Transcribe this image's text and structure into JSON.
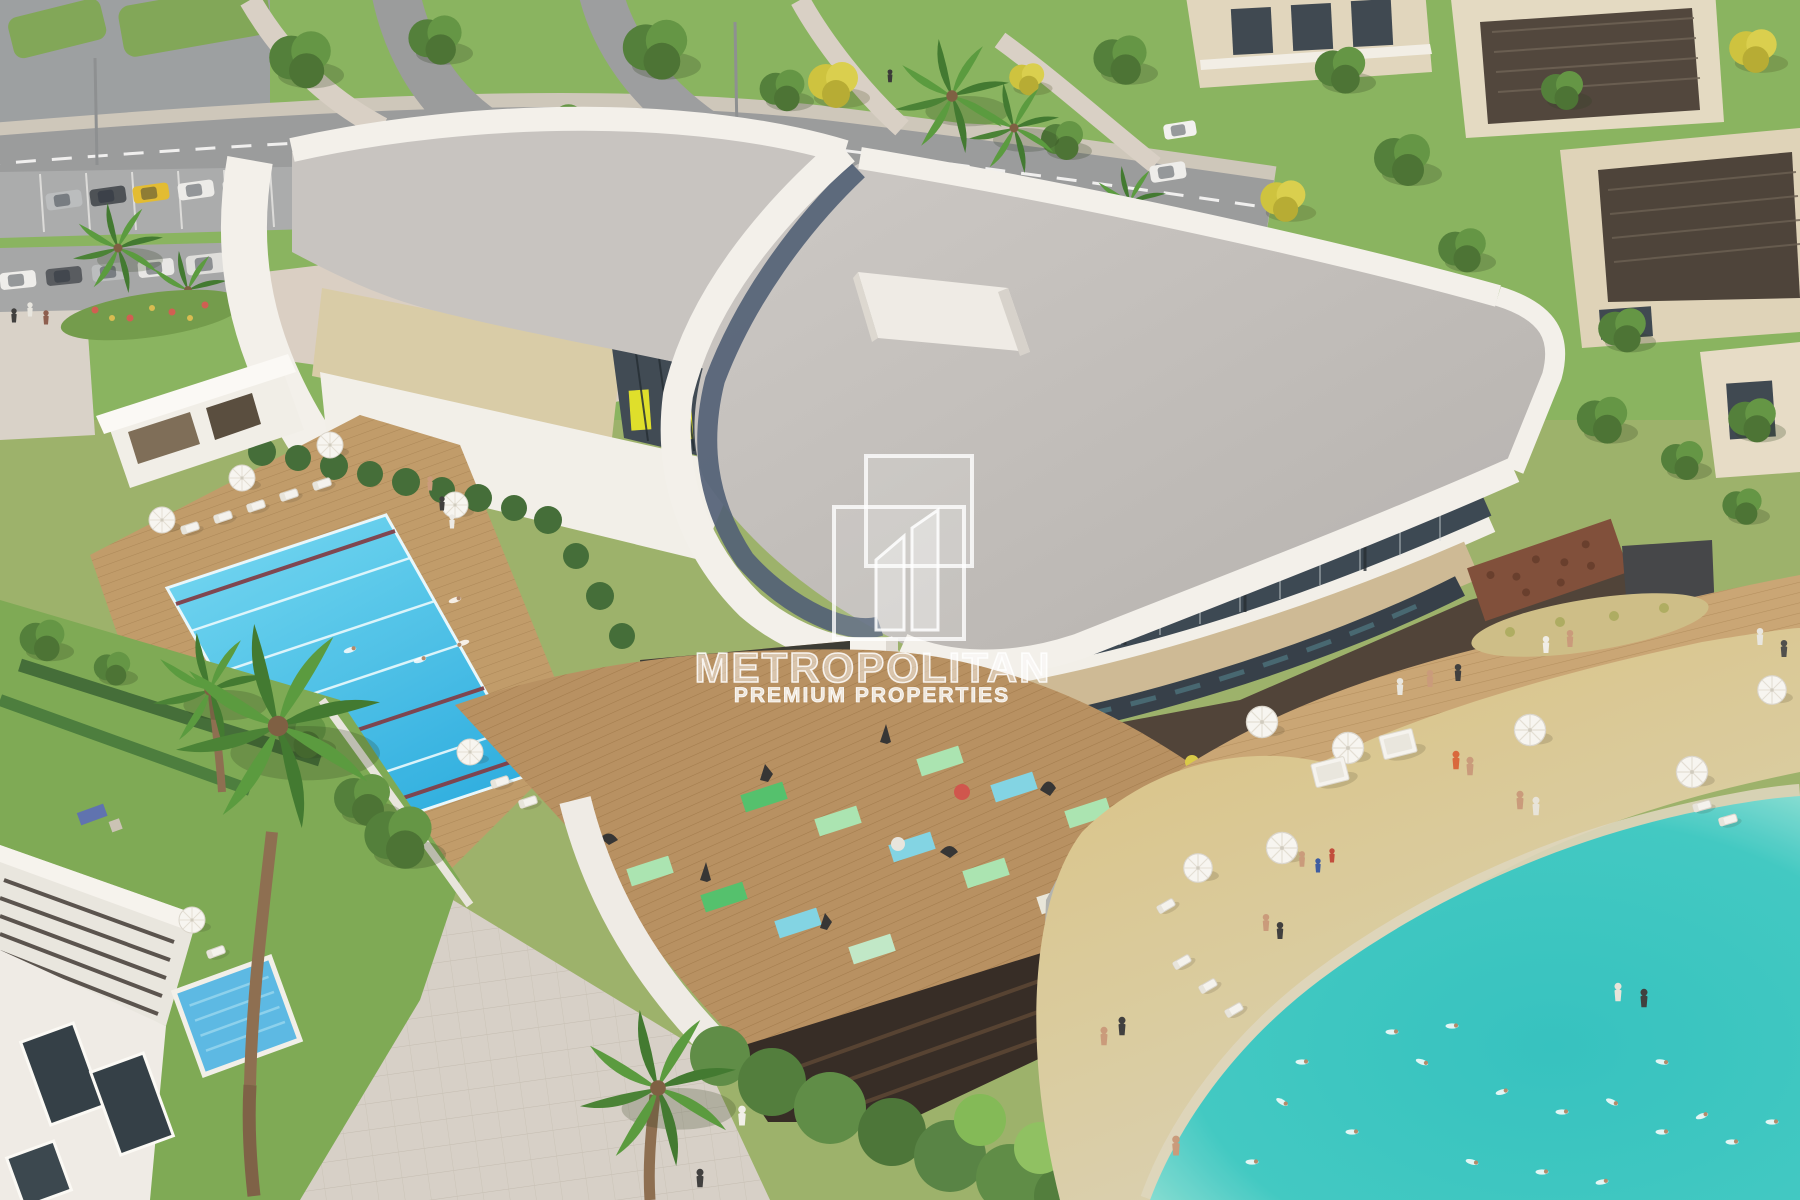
{
  "watermark": {
    "brand": "METROPOLITAN",
    "tagline": "PREMIUM PROPERTIES",
    "logo": "overlapping-towers-icon"
  },
  "scene": {
    "type": "aerial-architectural-render",
    "features": [
      "curved white clubhouse with gray roof",
      "lap pool with lane ropes",
      "outdoor yoga deck with mats",
      "lagoon beach pool with swimmers",
      "wooden boardwalk and sandy beach",
      "sun umbrellas and loungers",
      "palm trees and landscaped lawns",
      "roads with parked cars",
      "beige villas with pergola roofs"
    ]
  },
  "palette": {
    "building_white": "#f3f1ec",
    "roof_gray": "#c4c1be",
    "roof_band_blue": "#4d5c73",
    "beige_panel": "#d8cba6",
    "glass_dark": "#36434f",
    "interior_yellow": "#dedf25",
    "lap_pool_blue": "#3ec2ea",
    "lane_rope_red": "#7c3a44",
    "yoga_deck_wood": "#b68e5e",
    "boardwalk_wood": "#c8a472",
    "sand": "#d8c180",
    "lagoon_turquoise": "#2fc1bf",
    "grass": "#7fae57",
    "road": "#97999b",
    "hedge": "#3e6a33",
    "villa_wall": "#e3dac2",
    "pergola_dark": "#4b4138",
    "watermark_white": "#ffffff"
  }
}
